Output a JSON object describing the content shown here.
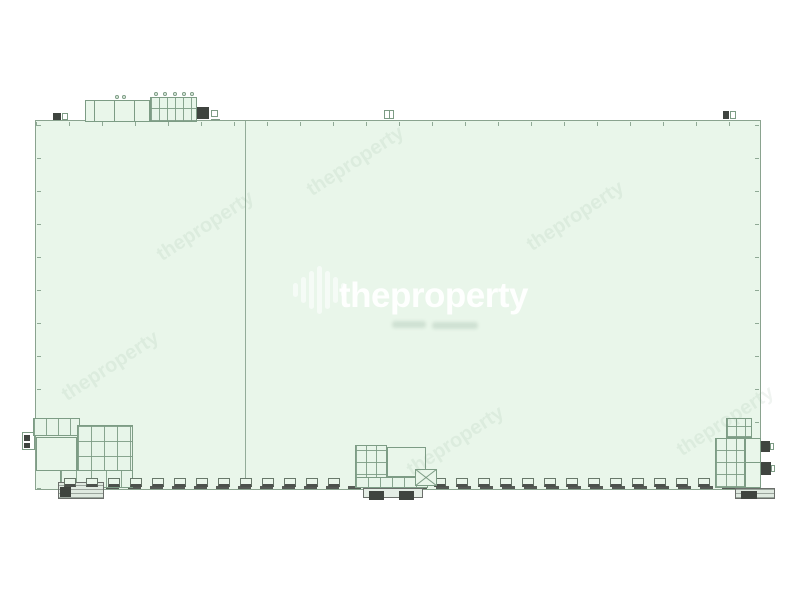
{
  "watermark": {
    "brand": "theproperty",
    "icon": "equalizer-bars-icon",
    "text_color": "#ffffff"
  },
  "colors": {
    "background": "#ffffff",
    "floor_fill": "#e9f6ea",
    "wall_line": "#8aa38f",
    "detail_line": "#7d9c85",
    "dark_fill": "#3f443f",
    "interior_wall": "#93ac99",
    "dock_base": "#4c514c"
  },
  "plan": {
    "type": "warehouse-floor-plan",
    "bays": 2,
    "dock_rows": [
      {
        "x_start": 64,
        "x_end": 340,
        "count": 13
      },
      {
        "x_start": 434,
        "x_end": 710,
        "count": 13
      }
    ]
  }
}
